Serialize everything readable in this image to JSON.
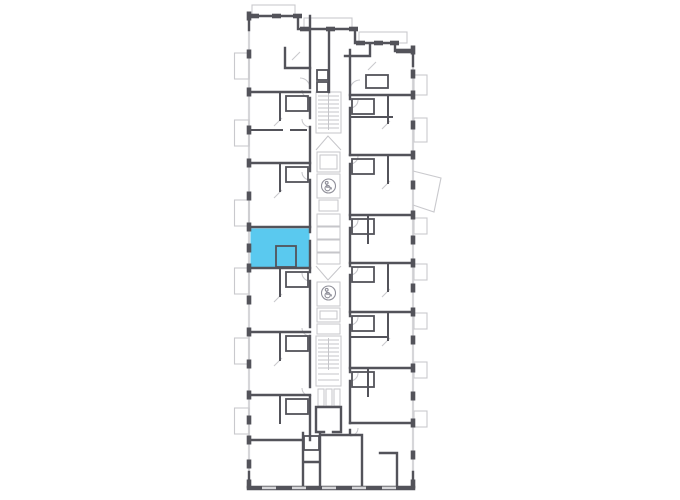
{
  "canvas": {
    "width": 680,
    "height": 500,
    "background": "#ffffff"
  },
  "floor_plan": {
    "kind": "residential-building-floor-plan",
    "colors": {
      "wall": "#53535a",
      "light_line": "#c9c9cd",
      "core_line": "#c6c6ca",
      "window_strip": "#d6d6d9",
      "window_tick": "#d6d6d9",
      "icon": "#90909a",
      "highlight_fill": "#5ac9ef",
      "background": "#ffffff"
    },
    "highlighted_unit": {
      "name": "selected-apartment",
      "side": "left",
      "state": "highlighted"
    },
    "core": {
      "stairwells": 2,
      "elevator_banks": 2,
      "accessible_elevator_icons": 2,
      "accessible_icon_name": "wheelchair-icon"
    }
  }
}
